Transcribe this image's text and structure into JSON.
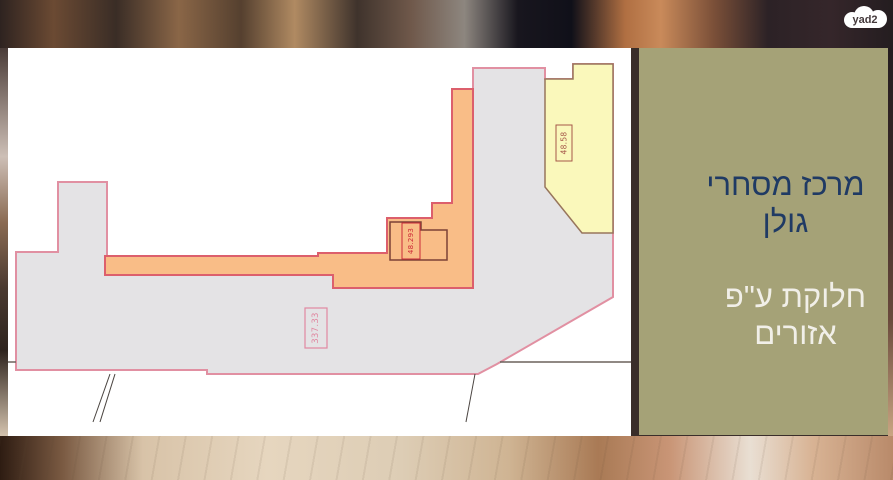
{
  "page": {
    "width": 893,
    "height": 480
  },
  "logo": {
    "text": "yad2"
  },
  "info_panel": {
    "title_line1": "מרכז מסחרי",
    "title_line2": "גולן",
    "subtitle_line1": "חלוקת ע\"פ",
    "subtitle_line2": "אזורים",
    "background_color": "#a5a277",
    "title_color": "#1f3a64",
    "subtitle_color": "#f1efe8"
  },
  "floor_plan": {
    "background_color": "#ffffff",
    "zones": [
      {
        "name": "main-building",
        "fill": "#e4e3e5",
        "stroke": "#e190a2"
      },
      {
        "name": "corridor-zone",
        "fill": "#f9bd87",
        "stroke": "#dc5f6c"
      },
      {
        "name": "yellow-unit",
        "fill": "#faf8bb",
        "stroke": "#97755c"
      }
    ],
    "labels": [
      {
        "text": "48.58",
        "zone": "yellow-unit"
      },
      {
        "text": "48.293",
        "zone": "corridor-room"
      },
      {
        "text": "337.33",
        "zone": "main-building"
      }
    ]
  }
}
